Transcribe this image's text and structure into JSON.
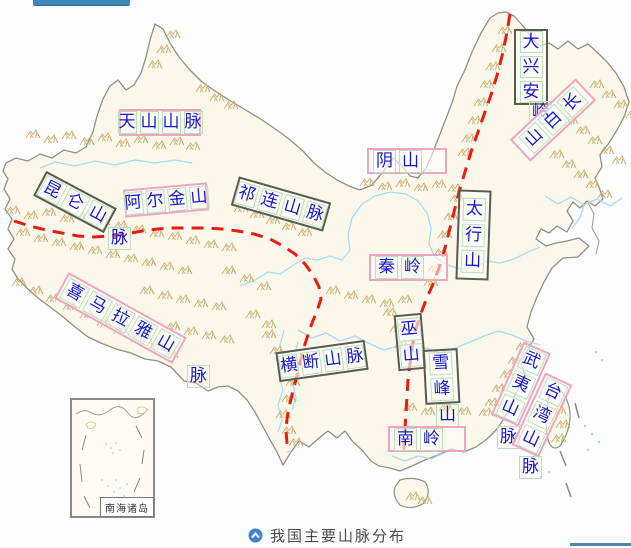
{
  "map": {
    "labels": [
      {
        "id": "tianshan",
        "text": "天山山脉",
        "box_style": "pink"
      },
      {
        "id": "kunlun",
        "text": "昆仑山",
        "overflow_char": "脉",
        "box_style": "dark"
      },
      {
        "id": "aerjin",
        "text": "阿尔金山",
        "box_style": "pink"
      },
      {
        "id": "qilian",
        "text": "祁连山脉",
        "box_style": "dark"
      },
      {
        "id": "yinshan",
        "text": "阴山",
        "box_style": "pink"
      },
      {
        "id": "daxinganling",
        "text": "大兴安",
        "overflow_char": "岭",
        "box_style": "dark"
      },
      {
        "id": "changbaishan",
        "text": "长白山",
        "box_style": "pink"
      },
      {
        "id": "taihangshan",
        "text": "太行山",
        "box_style": "dark"
      },
      {
        "id": "qinling",
        "text": "秦岭",
        "box_style": "pink"
      },
      {
        "id": "ximalaya",
        "text": "喜马拉雅山",
        "overflow_char": "脉",
        "box_style": "pink"
      },
      {
        "id": "hengduan",
        "text": "横断山脉",
        "box_style": "dark"
      },
      {
        "id": "wushan",
        "text": "巫山",
        "box_style": "dark"
      },
      {
        "id": "xuefengshan",
        "text": "雪峰",
        "overflow_char": "山",
        "box_style": "dark"
      },
      {
        "id": "nanling",
        "text": "南岭",
        "box_style": "pink"
      },
      {
        "id": "wuyishan",
        "text": "武夷山",
        "overflow_char": "脉",
        "box_style": "pink"
      },
      {
        "id": "taiwanshan",
        "text": "台湾山",
        "overflow_char": "脉",
        "box_style": "pink"
      }
    ],
    "inset_label": "南海诸岛",
    "colors": {
      "label_text": "#1717cf",
      "pink_border": "#f2a3bf",
      "dark_border": "#5a5a50",
      "char_box": "#b9e0bb",
      "red_step_line": "#e81c10",
      "mountain_symbol": "#c9b478",
      "river": "#a5dced",
      "country_border": "#8f8f88",
      "land_fill": "#fbf7eb"
    }
  },
  "caption": {
    "text": "我国主要山脉分布",
    "icon": "circle-up-arrow",
    "icon_color": "#3f83d2",
    "text_color": "#4b4b4b"
  },
  "decorations": {
    "top_bar_color": "#3e86ba",
    "bottom_bar_color": "#4a87ad"
  }
}
